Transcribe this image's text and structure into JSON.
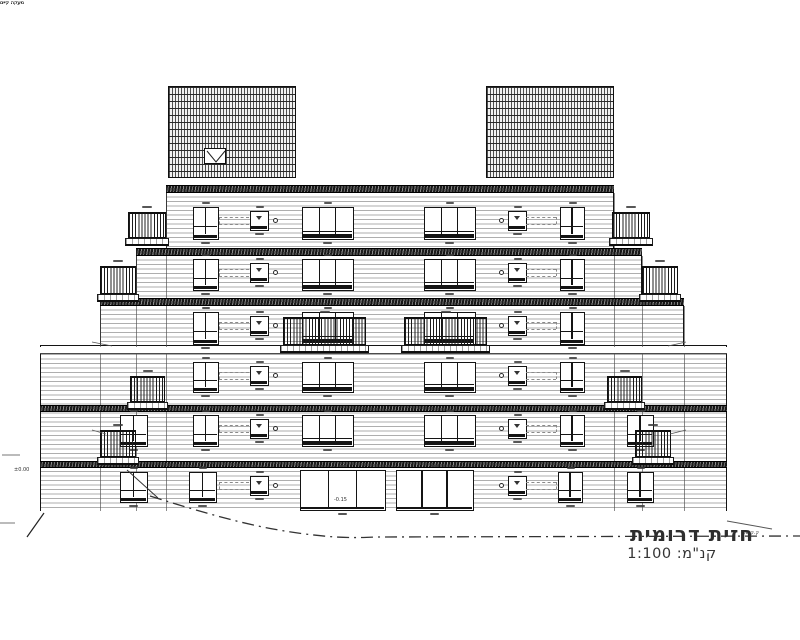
{
  "title_block": {
    "title": "חזית דרומית",
    "scale_label": "קנ\"מ: 1:100"
  },
  "annotations": {
    "railing_note": "מעקה קיים",
    "level_zero": "±0.00",
    "floor_level": "-0.15",
    "ground_line_label": "ק.ק.ט."
  },
  "colors": {
    "line": "#141414",
    "siding": "#aeaeae",
    "slab_dark": "#2e2e2e",
    "ground_blue": "#2aa4da",
    "accent_red": "#a63c2e"
  },
  "geometry": {
    "tiers": [
      {
        "x": 166,
        "y": 193,
        "w": 448,
        "h": 55,
        "top": false
      },
      {
        "x": 136,
        "y": 256,
        "w": 506,
        "h": 42,
        "top": false
      },
      {
        "x": 100,
        "y": 306,
        "w": 584,
        "h": 39,
        "top": false
      },
      {
        "x": 40,
        "y": 345,
        "w": 687,
        "h": 166,
        "top": true
      }
    ],
    "bands": [
      {
        "x": 166,
        "y": 185,
        "w": 448,
        "h": 8,
        "dark": true
      },
      {
        "x": 136,
        "y": 248,
        "w": 506,
        "h": 8,
        "dark": true
      },
      {
        "x": 100,
        "y": 298,
        "w": 584,
        "h": 8,
        "dark": true
      },
      {
        "x": 40,
        "y": 347,
        "w": 687,
        "h": 7,
        "dark": false
      },
      {
        "x": 40,
        "y": 405,
        "w": 687,
        "h": 7,
        "dark": true
      },
      {
        "x": 40,
        "y": 461,
        "w": 687,
        "h": 7,
        "dark": true
      }
    ],
    "joints": [
      {
        "x": 166,
        "y": 193
      },
      {
        "x": 614,
        "y": 193
      },
      {
        "x": 136,
        "y": 256
      },
      {
        "x": 642,
        "y": 256
      },
      {
        "x": 100,
        "y": 306
      },
      {
        "x": 684,
        "y": 306
      }
    ],
    "rows": [
      {
        "y": 207,
        "h": 33,
        "openings": [
          {
            "t": "w2",
            "x": 193,
            "w": 26
          },
          {
            "t": "sq",
            "x": 250,
            "w": 19,
            "c": "r"
          },
          {
            "t": "w3",
            "x": 302,
            "w": 52
          },
          {
            "t": "w3",
            "x": 424,
            "w": 52
          },
          {
            "t": "sq",
            "x": 508,
            "w": 19,
            "c": "l"
          },
          {
            "t": "w2",
            "x": 560,
            "w": 25
          }
        ]
      },
      {
        "y": 259,
        "h": 32,
        "openings": [
          {
            "t": "w2",
            "x": 193,
            "w": 26
          },
          {
            "t": "sq",
            "x": 250,
            "w": 19,
            "c": "r"
          },
          {
            "t": "w3",
            "x": 302,
            "w": 52
          },
          {
            "t": "w3",
            "x": 424,
            "w": 52
          },
          {
            "t": "sq",
            "x": 508,
            "w": 19,
            "c": "l"
          },
          {
            "t": "w2",
            "x": 560,
            "w": 25
          }
        ]
      },
      {
        "y": 312,
        "h": 33,
        "openings": [
          {
            "t": "w2",
            "x": 193,
            "w": 26
          },
          {
            "t": "sq",
            "x": 250,
            "w": 19,
            "c": "r"
          },
          {
            "t": "w3",
            "x": 302,
            "w": 52
          },
          {
            "t": "w3",
            "x": 424,
            "w": 52
          },
          {
            "t": "sq",
            "x": 508,
            "w": 19,
            "c": "l"
          },
          {
            "t": "w2",
            "x": 560,
            "w": 25
          }
        ]
      },
      {
        "y": 362,
        "h": 31,
        "openings": [
          {
            "t": "w2",
            "x": 193,
            "w": 26
          },
          {
            "t": "sq",
            "x": 250,
            "w": 19,
            "c": "r"
          },
          {
            "t": "w3",
            "x": 302,
            "w": 52
          },
          {
            "t": "w3",
            "x": 424,
            "w": 52
          },
          {
            "t": "sq",
            "x": 508,
            "w": 19,
            "c": "l"
          },
          {
            "t": "w2",
            "x": 560,
            "w": 25
          }
        ]
      },
      {
        "y": 415,
        "h": 32,
        "openings": [
          {
            "t": "w2",
            "x": 120,
            "w": 28
          },
          {
            "t": "w2",
            "x": 193,
            "w": 26
          },
          {
            "t": "sq",
            "x": 250,
            "w": 19,
            "c": "r"
          },
          {
            "t": "w3",
            "x": 302,
            "w": 52
          },
          {
            "t": "w3",
            "x": 424,
            "w": 52
          },
          {
            "t": "sq",
            "x": 508,
            "w": 19,
            "c": "l"
          },
          {
            "t": "w2",
            "x": 560,
            "w": 25
          },
          {
            "t": "w2",
            "x": 627,
            "w": 27
          }
        ]
      },
      {
        "y": 472,
        "h": 31,
        "openings": [
          {
            "t": "w2",
            "x": 120,
            "w": 28
          },
          {
            "t": "w2",
            "x": 189,
            "w": 28
          },
          {
            "t": "sq",
            "x": 250,
            "w": 19,
            "c": "r"
          },
          {
            "t": "door",
            "x": 300,
            "w": 86,
            "y": 470,
            "h": 41
          },
          {
            "t": "door",
            "x": 396,
            "w": 78,
            "y": 470,
            "h": 41
          },
          {
            "t": "sq",
            "x": 508,
            "w": 19,
            "c": "l"
          },
          {
            "t": "w2",
            "x": 558,
            "w": 25
          },
          {
            "t": "w2",
            "x": 627,
            "w": 27
          }
        ]
      }
    ],
    "balconies": [
      {
        "x": 128,
        "y": 212,
        "w": 38,
        "rh": 26
      },
      {
        "x": 612,
        "y": 212,
        "w": 38,
        "rh": 26
      },
      {
        "x": 100,
        "y": 266,
        "w": 36,
        "rh": 28
      },
      {
        "x": 642,
        "y": 266,
        "w": 36,
        "rh": 28
      },
      {
        "x": 283,
        "y": 317,
        "w": 83,
        "rh": 28
      },
      {
        "x": 404,
        "y": 317,
        "w": 83,
        "rh": 28
      },
      {
        "x": 130,
        "y": 376,
        "w": 35,
        "rh": 26
      },
      {
        "x": 607,
        "y": 376,
        "w": 35,
        "rh": 26
      },
      {
        "x": 100,
        "y": 430,
        "w": 36,
        "rh": 27
      },
      {
        "x": 635,
        "y": 430,
        "w": 36,
        "rh": 27
      }
    ],
    "roof": {
      "hatch_blocks": [
        {
          "x": 168,
          "y": 86,
          "w": 128,
          "h": 92
        },
        {
          "x": 486,
          "y": 86,
          "w": 128,
          "h": 92
        }
      ],
      "vents": [
        {
          "x": 204,
          "y": 148
        },
        {
          "x": 556,
          "y": 148
        }
      ],
      "vent_w": 22,
      "vent_h": 16,
      "louver": {
        "x": 326,
        "y": 100,
        "w": 124,
        "h": 42
      },
      "beam": {
        "x": 296,
        "y": 142,
        "w": 190,
        "h": 10
      },
      "columns": {
        "xs": [
          301,
          346,
          430,
          474
        ],
        "y": 151,
        "h": 34,
        "w": 3
      },
      "railing": {
        "x": 300,
        "y": 161,
        "w": 178,
        "h": 23
      },
      "door": {
        "x": 368,
        "y": 147,
        "w": 29,
        "h": 38
      },
      "marks": [
        [
          144,
          79
        ],
        [
          616,
          79
        ],
        [
          222,
          80
        ],
        [
          540,
          80
        ],
        [
          377,
          94
        ],
        [
          331,
          138
        ],
        [
          144,
          154
        ],
        [
          620,
          154
        ]
      ]
    },
    "ground": {
      "blue_band": {
        "x": 45,
        "y": 511,
        "w": 678,
        "h": 9
      },
      "blue_verticals": [
        {
          "x": 41,
          "y": 474,
          "h": 38
        },
        {
          "x": 386,
          "y": 472,
          "h": 40
        },
        {
          "x": 715,
          "y": 470,
          "h": 42
        },
        {
          "x": 719,
          "y": 520,
          "h": 9
        }
      ],
      "red_ticks": [
        {
          "x": 40,
          "y": 474,
          "h": 38
        },
        {
          "x": 714,
          "y": 470,
          "h": 42
        }
      ],
      "level_line": {
        "x": 46,
        "y": 471,
        "w": 118
      }
    },
    "notes": [
      {
        "x": 56,
        "y": 337
      },
      {
        "x": 686,
        "y": 337
      },
      {
        "x": 58,
        "y": 425
      },
      {
        "x": 686,
        "y": 425
      }
    ]
  }
}
